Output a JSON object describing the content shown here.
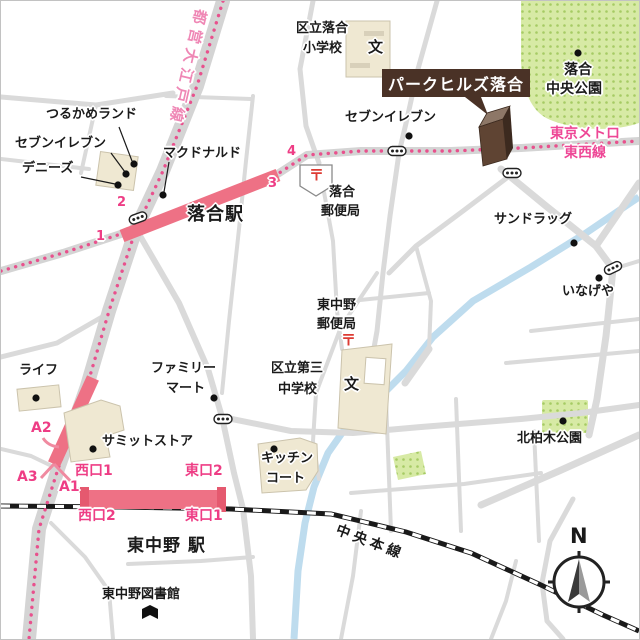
{
  "landmark": {
    "label": "パークヒルズ落合"
  },
  "rail": {
    "oedo": {
      "name": "都営大江戸線"
    },
    "tozai": {
      "name_line1": "東京メトロ",
      "name_line2": "東西線"
    },
    "chuo": {
      "name": "中央本線"
    }
  },
  "stations": {
    "ochiai": {
      "name": "落合駅",
      "exits": {
        "n1": "1",
        "n2": "2",
        "n3": "3",
        "n4": "4"
      }
    },
    "higashinakano": {
      "name": "東中野 駅",
      "exits": {
        "west1": "西口1",
        "west2": "西口2",
        "east1": "東口1",
        "east2": "東口2",
        "a1": "A1",
        "a2": "A2",
        "a3": "A3"
      }
    }
  },
  "pois": {
    "tsurukame": {
      "label": "つるかめランド"
    },
    "seveneleven_west": {
      "label": "セブンイレブン"
    },
    "dennys": {
      "label": "デニーズ"
    },
    "mcdonalds": {
      "label": "マクドナルド"
    },
    "seveneleven_north": {
      "label": "セブンイレブン"
    },
    "sundrug": {
      "label": "サンドラッグ"
    },
    "inageya": {
      "label": "いなげや"
    },
    "life": {
      "label": "ライフ"
    },
    "familymart": {
      "line1": "ファミリー",
      "line2": "マート"
    },
    "summit": {
      "label": "サミットストア"
    },
    "kitchencourt": {
      "line1": "キッチン",
      "line2": "コート"
    },
    "library": {
      "label": "東中野図書館"
    }
  },
  "parks": {
    "ochiai_chuo": {
      "line1": "落合",
      "line2": "中央公園"
    },
    "kitakashiwagi": {
      "label": "北柏木公園"
    }
  },
  "schools": {
    "ochiai_elementary": {
      "line1": "区立落合",
      "line2": "小学校",
      "mark": "文"
    },
    "daisan_junior": {
      "line1": "区立第三",
      "line2": "中学校",
      "mark": "文"
    }
  },
  "post_offices": {
    "ochiai": {
      "line1": "落合",
      "line2": "郵便局",
      "mark": "〒"
    },
    "higashinakano": {
      "line1": "東中野",
      "line2": "郵便局",
      "mark": "〒"
    }
  },
  "compass": {
    "north": "N"
  },
  "colors": {
    "station_bar": "#ee7185",
    "line_pink": "#e8518d",
    "exit_pink": "#ee3d85",
    "park_green": "#d7eaa5",
    "building_beige": "#efe8d2",
    "brand_brown": "#4a3226",
    "river_blue": "#bedcee",
    "road_gray": "#dadada",
    "post_red": "#dd3b33"
  }
}
